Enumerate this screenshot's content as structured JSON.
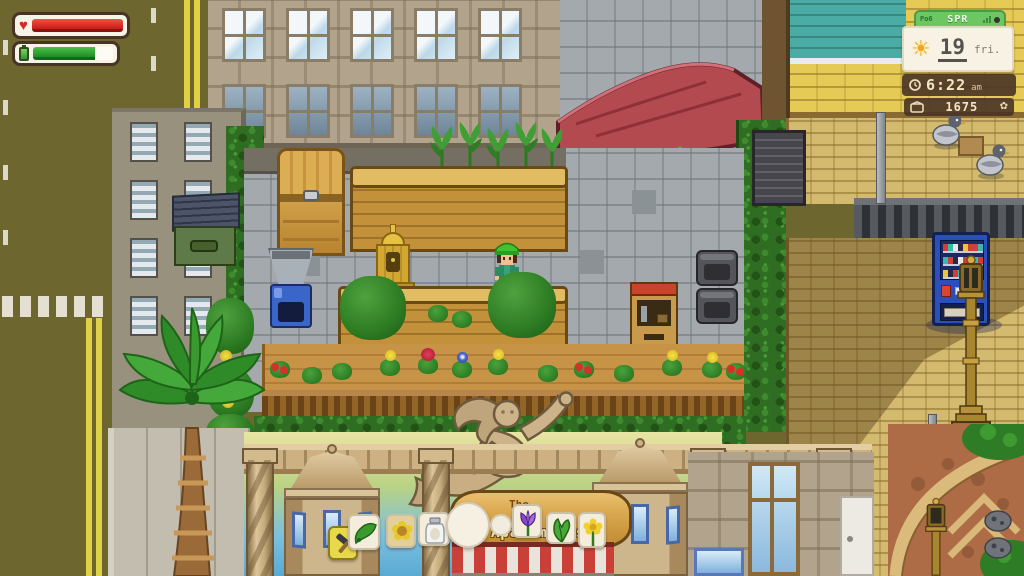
{
  "hud": {
    "health_bar": {
      "name": "health",
      "fill_pct": 100,
      "color": "#e03028"
    },
    "energy_bar": {
      "name": "energy",
      "fill_pct": 77,
      "color": "#2aa32e"
    },
    "clock": {
      "status_left": "Po6",
      "season": "SPR",
      "day": "19",
      "weekday": "fri.",
      "time": "6:22",
      "meridiem": "am",
      "money": "1675",
      "panel_green": "#6cc664",
      "panel_brown": "#4a3527",
      "icons": [
        "sun-icon",
        "clock-icon",
        "wallet-icon",
        "flower-icon",
        "signal-icon",
        "camera-dot-icon"
      ]
    }
  },
  "scene": {
    "pool_sign": "POOL",
    "apartment_sign": {
      "line1": "The",
      "line2": "Apartments"
    },
    "item_bubbles": [
      "hammer",
      "leek",
      "sunflower",
      "mayonnaise-jar",
      "egg",
      "pearl",
      "crocus",
      "lettuce",
      "daffodil"
    ],
    "objects": [
      "wooden-trunk",
      "gold-shrine",
      "recycling-machine",
      "garden-planter",
      "street-kiosk",
      "metal-chairs",
      "vending-machine",
      "dumpster",
      "drinking-fountain",
      "pool-door",
      "mermaid-statue",
      "palm-tree",
      "lamp-post",
      "pigeons"
    ],
    "colors": {
      "road": "#6d672f",
      "road_line": "#e0d044",
      "hedge": "#2f6e22",
      "wood": "#c3913a",
      "pool_wall": "#8ec7ea",
      "pool_roof": "#b24a50",
      "vending": "#2b50bc",
      "brick": "#d4ba6e",
      "awning_red": "#c84038",
      "mural_sky": "#7cc0de"
    }
  }
}
